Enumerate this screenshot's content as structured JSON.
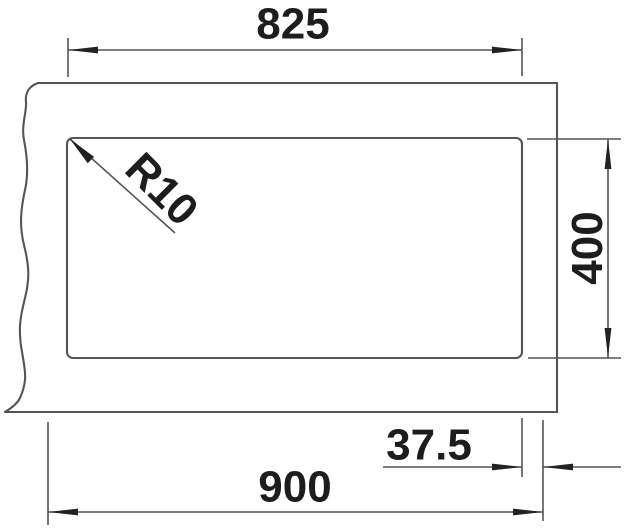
{
  "drawing": {
    "type": "technical-dimension-drawing",
    "subject": "sink-cutout-plan-view",
    "labels": {
      "cutout_width": "825",
      "cutout_height": "400",
      "overall_width": "900",
      "edge_offset": "37.5",
      "corner_radius": "R10"
    },
    "colors": {
      "line": "#555555",
      "text": "#1d1d1d",
      "arrow": "#222222",
      "background": "#ffffff"
    }
  }
}
